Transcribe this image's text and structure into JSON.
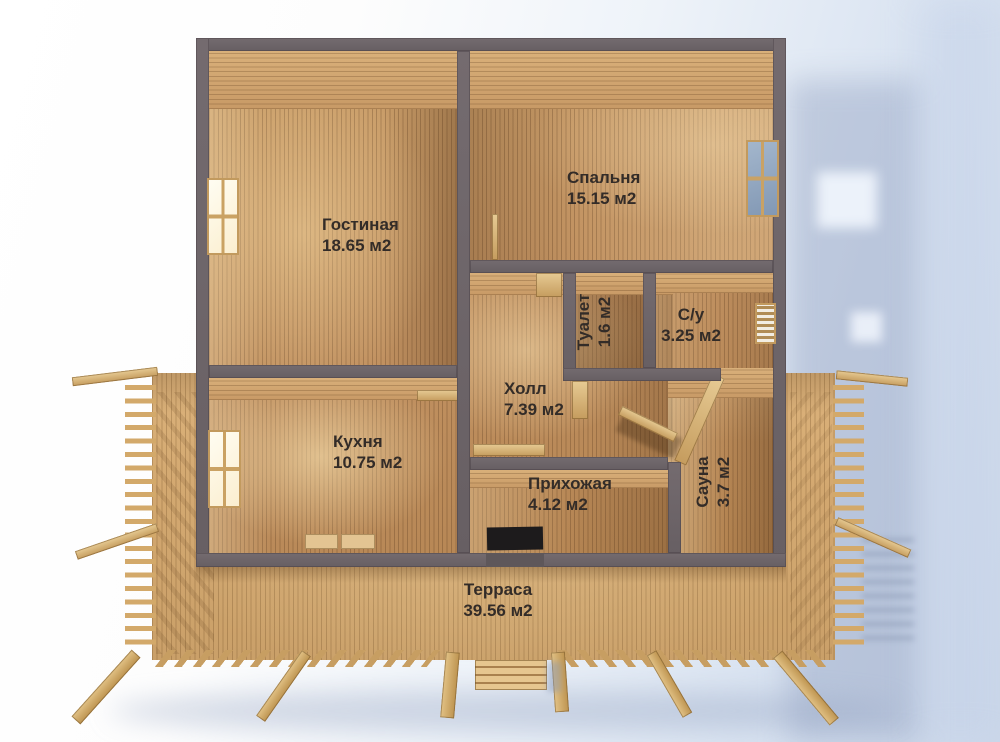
{
  "rooms": [
    {
      "id": "living",
      "label": "Гостиная",
      "area": "18.65 м2"
    },
    {
      "id": "bedroom",
      "label": "Спальня",
      "area": "15.15 м2"
    },
    {
      "id": "kitchen",
      "label": "Кухня",
      "area": "10.75 м2"
    },
    {
      "id": "hall",
      "label": "Холл",
      "area": "7.39 м2"
    },
    {
      "id": "entry",
      "label": "Прихожая",
      "area": "4.12 м2"
    },
    {
      "id": "toilet",
      "label": "Туалет",
      "area": "1.6 м2"
    },
    {
      "id": "bathroom",
      "label": "С/у",
      "area": "3.25 м2"
    },
    {
      "id": "sauna",
      "label": "Сауна",
      "area": "3.7 м2"
    },
    {
      "id": "terrace",
      "label": "Терраса",
      "area": "39.56 м2"
    }
  ],
  "colors": {
    "wall": "#6d6468",
    "floor_wood": "#c09060",
    "deck_wood": "#d2a76f",
    "beam_wood": "#c79e62",
    "background_right": "#ccd8ea",
    "glass": "#8298b4",
    "label_text": "#332c28"
  }
}
